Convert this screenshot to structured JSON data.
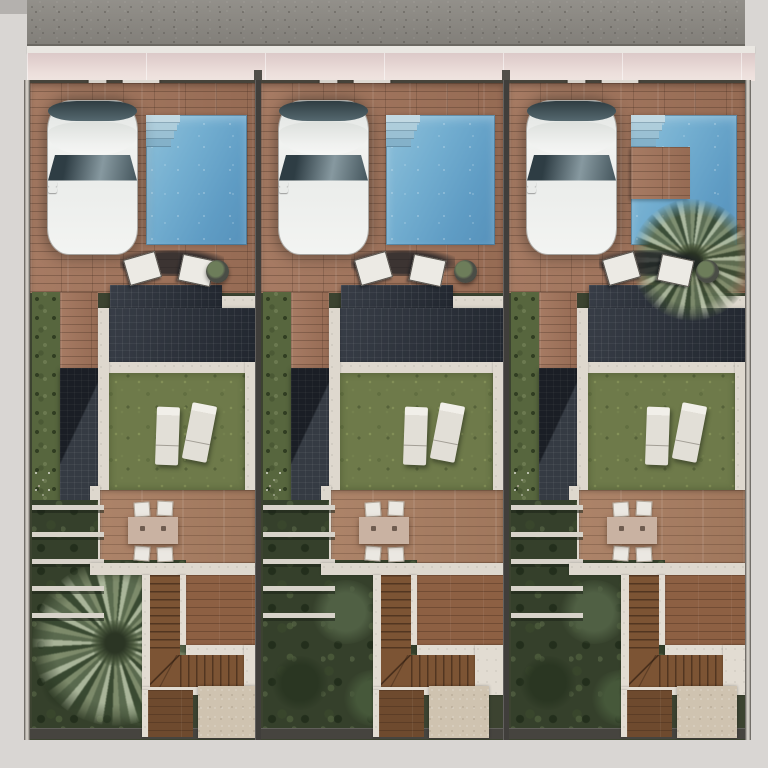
{
  "meta": {
    "title": "Aerial top-view site plan render — three attached villas with pools and gardens",
    "visible_text": "none"
  },
  "scene": {
    "environment": {
      "road": "asphalt street along the top edge",
      "curb": "white curb line",
      "sidewalk": "pale pink concrete sidewalk",
      "margins": "light grey paper margin on left, right and bottom",
      "boundaries": "dark party walls separating the three identical plots"
    },
    "units": [
      {
        "id": "villa-1",
        "variant": "garden-palm",
        "vehicle": "white car parked on tiled driveway",
        "pool": "rectangular blue pool with corner entry steps",
        "rear_garden": "large palm tree over dense dark planting",
        "furniture": [
          "two folding chairs",
          "round planter",
          "two sun loungers on lawn",
          "dining table with four chairs"
        ]
      },
      {
        "id": "villa-2",
        "variant": "standard",
        "vehicle": "white car parked on tiled driveway",
        "pool": "rectangular blue pool with corner entry steps",
        "rear_garden": "dense dark planting with shrubs",
        "furniture": [
          "two folding chairs",
          "round planter",
          "two sun loungers on lawn",
          "dining table with four chairs"
        ]
      },
      {
        "id": "villa-3",
        "variant": "pool-palm",
        "vehicle": "white car parked on tiled driveway",
        "pool": "L-shaped blue pool with palm planter deck at its corner",
        "rear_garden": "dense dark planting with shrubs",
        "furniture": [
          "two folding chairs",
          "round planter",
          "two sun loungers on lawn",
          "dining table with four chairs"
        ]
      }
    ],
    "shared_features": [
      "front fence with entry and driveway gates",
      "wood-effect tiled driveway terrace",
      "dark flat roofs with panel grid texture",
      "side entrance canopy roof",
      "privet hedge along side boundary",
      "lawn with two sun loungers",
      "tiled dining patio",
      "louvered pergola over side garden",
      "L-shaped staircase with fan landing",
      "lower timber deck",
      "gravel utility pad",
      "dark rear boundary wall"
    ]
  },
  "palette": {
    "road": "#8d8a84",
    "curb": "#eae7e2",
    "sidewalk": "#e7d8d5",
    "drive_tile": "#a1735a",
    "patio_tile": "#a87d61",
    "pool_water": "#6aa6cc",
    "pool_steps": "#b9d3df",
    "roof_dark": "#272d37",
    "wall_light": "#ded8ce",
    "lawn_green": "#6e7a4a",
    "garden_dark": "#35402b",
    "hedge_green": "#57663e",
    "palm_green": "#7e9070",
    "stair_wood": "#7c5434",
    "gravel": "#cfc3b0",
    "car_body": "#f1f2f0",
    "boundary_wall": "#403e3b",
    "margin_grey": "#d9d6d3"
  }
}
